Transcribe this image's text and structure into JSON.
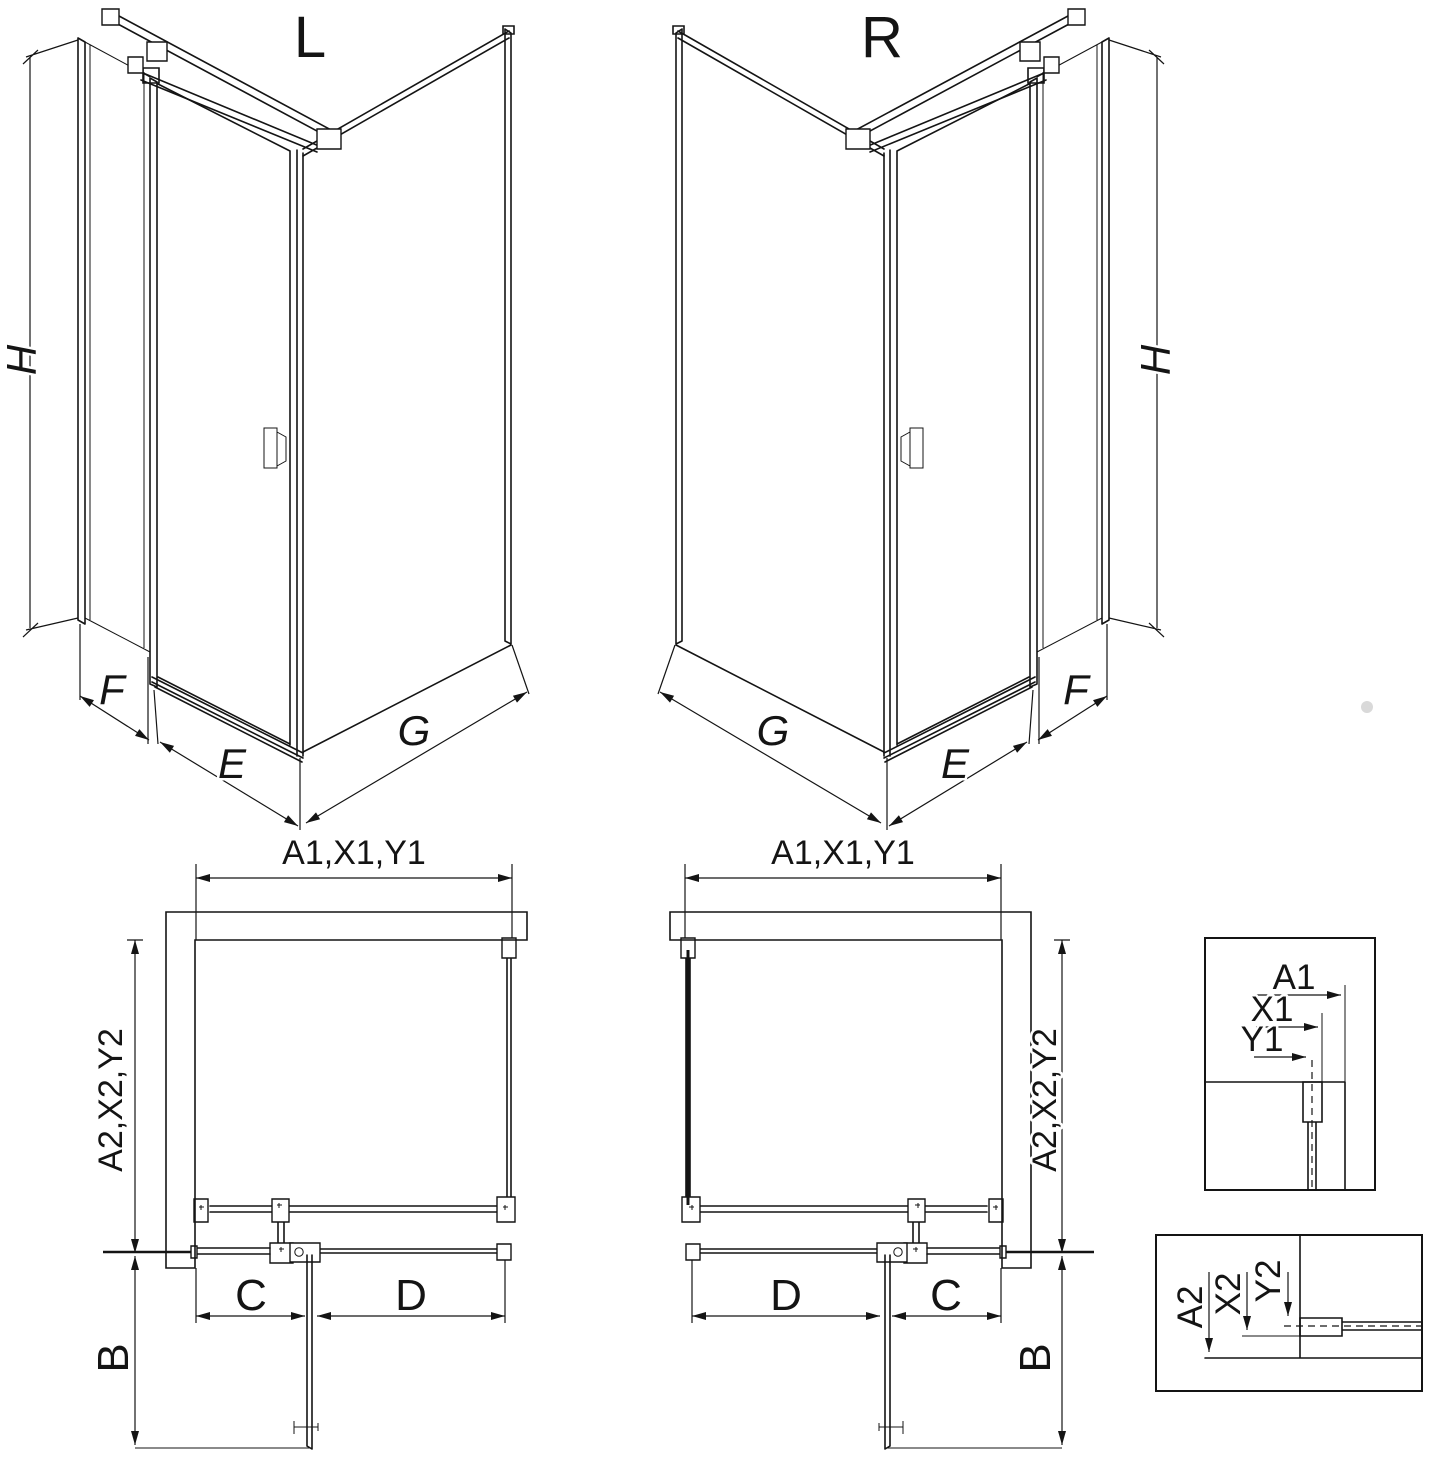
{
  "drawing": {
    "variant_left": {
      "title": "L",
      "height_label": "H",
      "side_panel_label": "F",
      "door_label": "E",
      "return_wall_label": "G"
    },
    "variant_right": {
      "title": "R",
      "height_label": "H",
      "side_panel_label": "F",
      "door_label": "E",
      "return_wall_label": "G"
    },
    "plan_left": {
      "width_label": "A1,X1,Y1",
      "depth_label": "A2,X2,Y2",
      "door_width_label": "C",
      "fixed_width_label": "D",
      "opening_label": "B"
    },
    "plan_right": {
      "width_label": "A1,X1,Y1",
      "depth_label": "A2,X2,Y2",
      "door_width_label": "C",
      "fixed_width_label": "D",
      "opening_label": "B"
    },
    "detail_wall_top": {
      "to_wall": "A1",
      "to_profile": "X1",
      "to_glass": "Y1"
    },
    "detail_wall_side": {
      "to_wall": "A2",
      "to_profile": "X2",
      "to_glass": "Y2"
    }
  }
}
